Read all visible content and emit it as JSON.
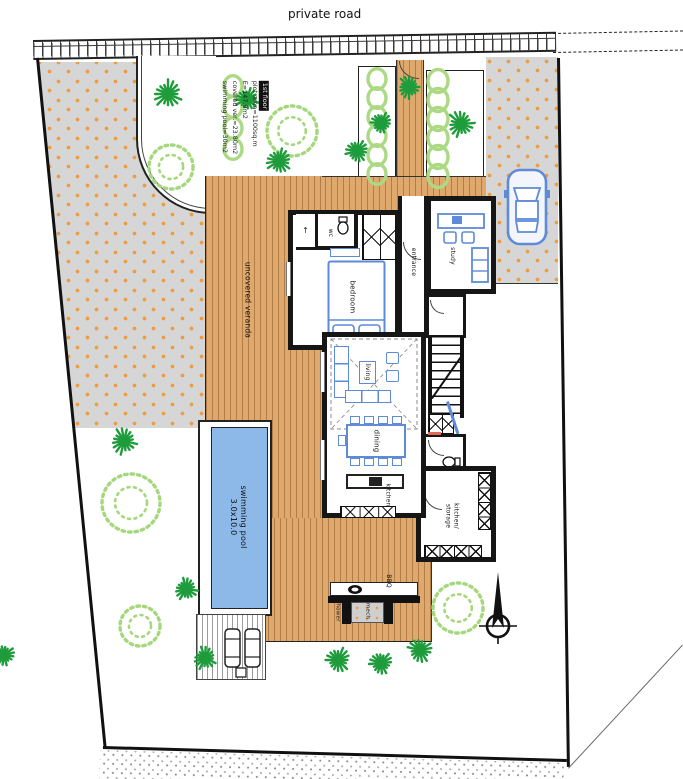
{
  "colors": {
    "deck": "#dfa96e",
    "deck_line": "#b9824a",
    "gravel_bg": "#d6d6d6",
    "gravel_dot": "#ef9b40",
    "pool_water": "#8db9e8",
    "furniture": "#5f8ad8",
    "palm_green": "#1e9c3c",
    "bush_green": "#a5d87c",
    "ring_green": "#abd984",
    "wall": "#161616",
    "accent_red": "#e06a5a"
  },
  "labels": {
    "road": "private road",
    "info": [
      "1st floor",
      "plot area=1100sq.m",
      "E=147.9m2",
      "covered ver.=23.80m2",
      "swimming pool=30m2"
    ],
    "veranda": "uncovered veranda",
    "pool": [
      "swimming pool",
      "3.0x10.0"
    ],
    "rooms": {
      "bedroom": "bedroom",
      "wc": "wc",
      "entrance": "entrance",
      "study": "study",
      "living": "living",
      "dining": "dining",
      "kitchen": "kitchen",
      "kitchen_storage_1": "kitchen/",
      "kitchen_storage_2": "storage",
      "bbq": "BBQ",
      "shower": "shower",
      "mech": "mech.",
      "arrow": "↑"
    }
  },
  "site": {
    "palms": [
      {
        "x": 168,
        "y": 94,
        "s": 30
      },
      {
        "x": 247,
        "y": 99,
        "s": 24
      },
      {
        "x": 279,
        "y": 161,
        "s": 26
      },
      {
        "x": 357,
        "y": 151,
        "s": 24
      },
      {
        "x": 381,
        "y": 123,
        "s": 22
      },
      {
        "x": 409,
        "y": 87,
        "s": 24
      },
      {
        "x": 461,
        "y": 124,
        "s": 28
      },
      {
        "x": 124,
        "y": 441,
        "s": 28
      },
      {
        "x": 186,
        "y": 589,
        "s": 24
      },
      {
        "x": 205,
        "y": 658,
        "s": 24
      },
      {
        "x": 338,
        "y": 660,
        "s": 26
      },
      {
        "x": 381,
        "y": 663,
        "s": 24
      },
      {
        "x": 420,
        "y": 650,
        "s": 26
      },
      {
        "x": 4,
        "y": 655,
        "s": 22
      }
    ],
    "bushes": [
      {
        "x": 292,
        "y": 131,
        "r": 25
      },
      {
        "x": 171,
        "y": 167,
        "r": 22
      },
      {
        "x": 131,
        "y": 503,
        "r": 29
      },
      {
        "x": 140,
        "y": 626,
        "r": 20
      },
      {
        "x": 458,
        "y": 608,
        "r": 25
      }
    ],
    "hedges": [
      {
        "x": 233,
        "y0": 86,
        "step": 21,
        "count": 4,
        "r": 9
      },
      {
        "x": 377,
        "y0": 79,
        "step": 19,
        "count": 6,
        "r": 9
      },
      {
        "x": 438,
        "y0": 81,
        "step": 19,
        "count": 6,
        "r": 10
      }
    ]
  }
}
